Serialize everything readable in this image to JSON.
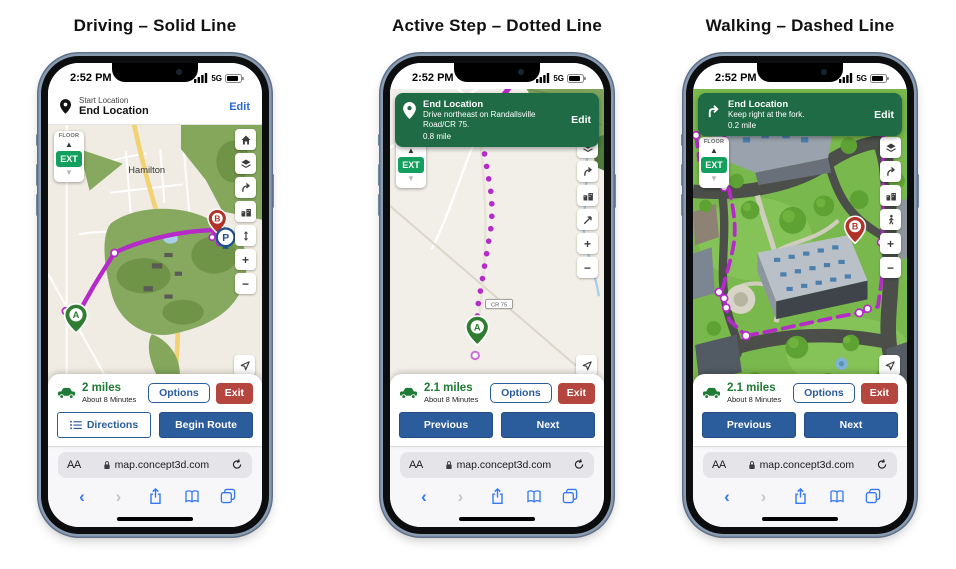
{
  "status": {
    "time": "2:52 PM",
    "network": "5G"
  },
  "floor": {
    "label": "FLOOR",
    "value": "EXT"
  },
  "safari": {
    "reader": "AA",
    "url": "map.concept3d.com"
  },
  "markers": {
    "start": "A",
    "parking": "P",
    "end": "B"
  },
  "colors": {
    "route_purple": "#b52bc9",
    "banner_green": "#1f6b45",
    "ext_green": "#13a05e",
    "primary_blue": "#2b5c9b",
    "exit_red": "#b5453f",
    "miles_green": "#1e7a34",
    "edit_blue": "#2e6bd6",
    "safari_blue": "#3478f6"
  },
  "phones": [
    {
      "title": "Driving – Solid Line",
      "header": {
        "start_label": "Start Location",
        "end_label": "End Location",
        "edit": "Edit"
      },
      "map": {
        "town": "Hamilton"
      },
      "summary": {
        "distance": "2 miles",
        "duration": "About 8 Minutes",
        "options": "Options",
        "exit": "Exit"
      },
      "actions": {
        "secondary": "Directions",
        "primary": "Begin Route"
      }
    },
    {
      "title": "Active Step – Dotted Line",
      "banner": {
        "title": "End Location",
        "instruction": "Drive northeast on Randallsville Road/CR 75.",
        "distance": "0.8 mile",
        "edit": "Edit"
      },
      "map": {
        "road_label": "CR 75"
      },
      "summary": {
        "distance": "2.1 miles",
        "duration": "About 8 Minutes",
        "options": "Options",
        "exit": "Exit"
      },
      "actions": {
        "secondary": "Previous",
        "primary": "Next"
      }
    },
    {
      "title": "Walking – Dashed Line",
      "banner": {
        "title": "End Location",
        "instruction": "Keep right at the fork.",
        "distance": "0.2 mile",
        "edit": "Edit"
      },
      "summary": {
        "distance": "2.1 miles",
        "duration": "About 8 Minutes",
        "options": "Options",
        "exit": "Exit"
      },
      "actions": {
        "secondary": "Previous",
        "primary": "Next"
      }
    }
  ]
}
